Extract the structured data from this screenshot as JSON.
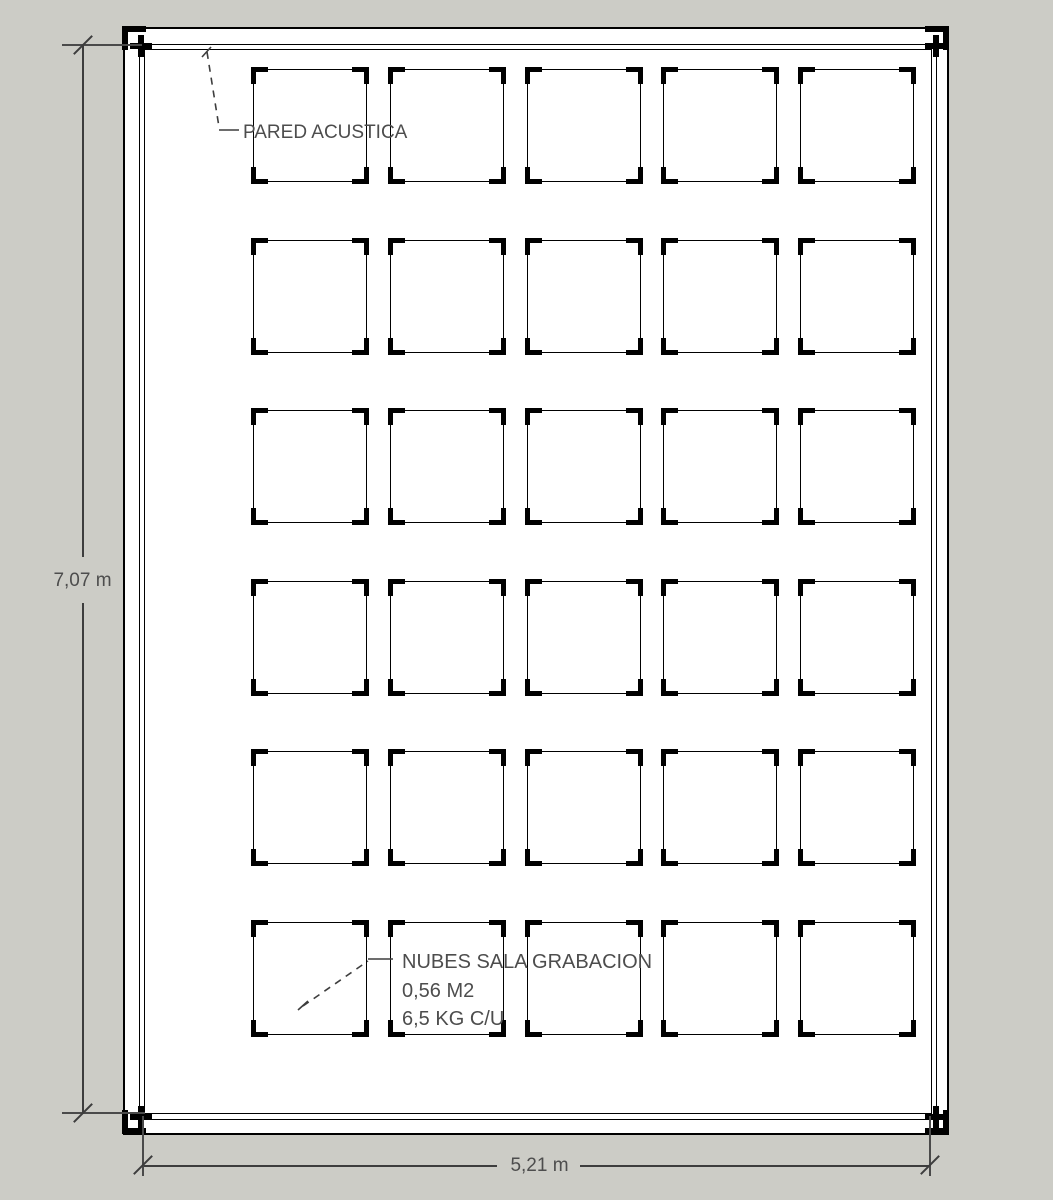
{
  "app": {
    "background_color": "#ccccc6",
    "paper_color": "#ffffff",
    "line_color": "#000000",
    "annotation_color": "#4d4d4d"
  },
  "annotations": {
    "wall_label": "PARED ACUSTICA",
    "cloud_label_line1": "NUBES SALA GRABACION",
    "cloud_label_line2": "0,56 M2",
    "cloud_label_line3": "6,5 KG C/U"
  },
  "dimensions": {
    "height": "7,07 m",
    "width": "5,21 m"
  },
  "grid": {
    "rows": 6,
    "cols": 5,
    "panel_count": 30,
    "origin_x": 253,
    "origin_y": 69,
    "pitch_x": 136.8,
    "pitch_y": 170.6,
    "panel_w": 114,
    "panel_h": 113
  }
}
